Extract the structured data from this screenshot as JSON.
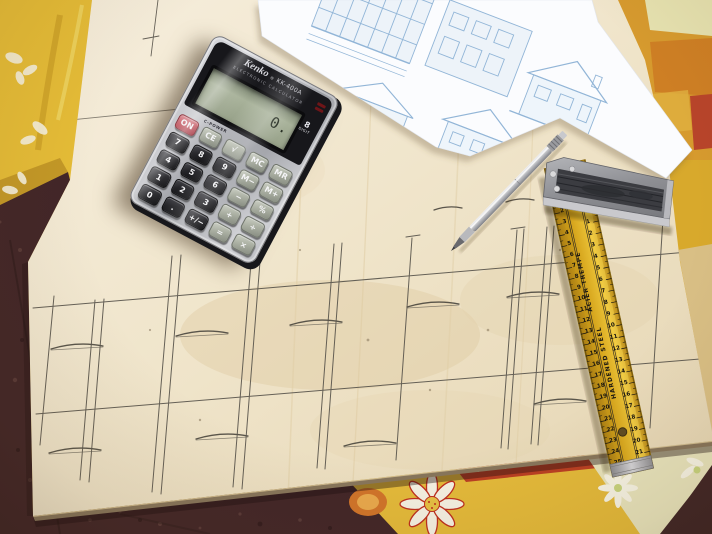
{
  "calculator": {
    "brand": "Kenko",
    "reg": "®",
    "model": "KK-400A",
    "tagline": "ELECTRONIC CALCULATOR",
    "solar_label": "C-POWER",
    "display_value": "0.",
    "digit_count": "8",
    "digit_label": "DIGIT",
    "keys": [
      {
        "label": "ON",
        "style": "red"
      },
      {
        "label": "CE",
        "style": "grey"
      },
      {
        "label": "√",
        "style": "grey"
      },
      {
        "label": "MC",
        "style": "grey"
      },
      {
        "label": "MR",
        "style": "grey"
      },
      {
        "label": "7",
        "style": "black"
      },
      {
        "label": "8",
        "style": "black"
      },
      {
        "label": "9",
        "style": "black"
      },
      {
        "label": "M−",
        "style": "grey"
      },
      {
        "label": "M+",
        "style": "grey"
      },
      {
        "label": "4",
        "style": "black"
      },
      {
        "label": "5",
        "style": "black"
      },
      {
        "label": "6",
        "style": "black"
      },
      {
        "label": "−",
        "style": "grey"
      },
      {
        "label": "%",
        "style": "grey"
      },
      {
        "label": "1",
        "style": "black"
      },
      {
        "label": "2",
        "style": "black"
      },
      {
        "label": "3",
        "style": "black"
      },
      {
        "label": "+",
        "style": "grey"
      },
      {
        "label": "÷",
        "style": "grey"
      },
      {
        "label": "0",
        "style": "black"
      },
      {
        "label": ".",
        "style": "black"
      },
      {
        "label": "+/−",
        "style": "black"
      },
      {
        "label": "=",
        "style": "grey"
      },
      {
        "label": "×",
        "style": "grey"
      }
    ]
  },
  "ruler": {
    "text_french": "ACIER TREMPE",
    "text_english": "HARDENED STEEL",
    "scale_left": [
      1,
      2,
      3,
      4,
      5,
      6,
      7,
      8,
      9,
      10,
      11,
      12,
      13,
      14,
      15,
      16,
      17,
      18,
      19,
      20,
      21,
      22,
      23,
      24,
      25
    ],
    "scale_right": [
      1,
      2,
      3,
      4,
      5,
      6,
      7,
      8,
      9,
      10,
      11,
      12,
      13,
      14,
      15,
      16,
      17,
      18,
      19,
      20,
      21
    ]
  },
  "colors": {
    "board": "#f1e7d0",
    "cloth_yellow": "#e3b93a",
    "cloth_pink": "#d5356c",
    "floor": "#452a2b",
    "ruler_yellow": "#e2b125",
    "blueprint_blue": "#8fb6dc",
    "pencil": "#56524a"
  }
}
